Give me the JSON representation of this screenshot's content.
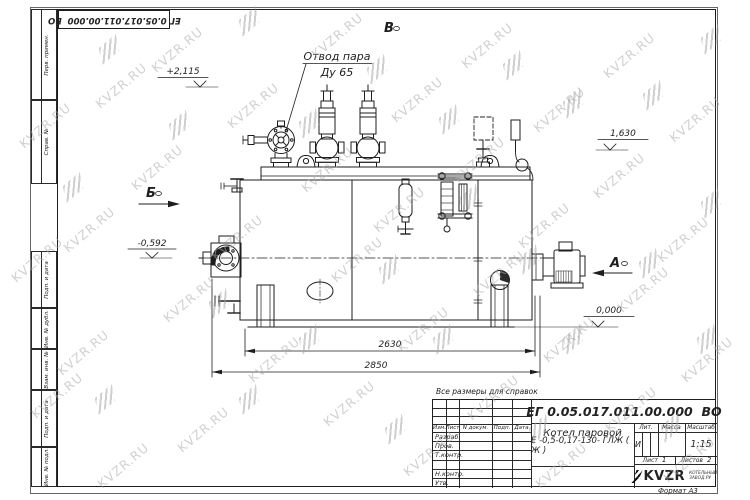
{
  "doc_number": "ЕГ 0.05.017.011.00.000  ВО",
  "format_label": "Формат А3",
  "reference_note": "Все размеры для справок",
  "watermark_text": "KVZR.RU",
  "margins": {
    "top": [
      "Перв. примен.",
      "Справ. №"
    ],
    "bottom": [
      "Подп. и дата",
      "Инв. № дубл.",
      "Взам. инв. №",
      "Подп. и дата",
      "Инв. № подл."
    ]
  },
  "drawing": {
    "callout": {
      "line1": "Отвод пара",
      "line2": "Ду 65"
    },
    "views": {
      "b": "Б",
      "a": "А",
      "v": "В"
    },
    "levels": {
      "valve_top": "+2,115",
      "right": "1,630",
      "burner_axis": "-0,592",
      "ground": "0,000"
    },
    "dims": {
      "base_length": "2630",
      "overall_length": "2850"
    }
  },
  "title_block": {
    "col_headers": [
      "Изм.",
      "Лист",
      "N докум.",
      "Подп.",
      "Дата"
    ],
    "row_labels": [
      "Разраб.",
      "Пров.",
      "Т.контр.",
      "",
      "Н.контр.",
      "Утв."
    ],
    "product_name": "Котел паровой",
    "product_type": "Е -0,5-0,17-130- ГЛЖ ( Ж )",
    "lit_label": "Лит.",
    "mass_label": "Масса",
    "scale_label": "Масштаб",
    "lit_value": "И",
    "scale_value": "1:15",
    "sheet_label": "Лист",
    "sheet_value": "1",
    "sheets_label": "Листов",
    "sheets_value": "2",
    "logo_text": "KVZR",
    "logo_sub1": "КОТЕЛЬНЫЙ",
    "logo_sub2": "ЗАВОД.РУ"
  }
}
